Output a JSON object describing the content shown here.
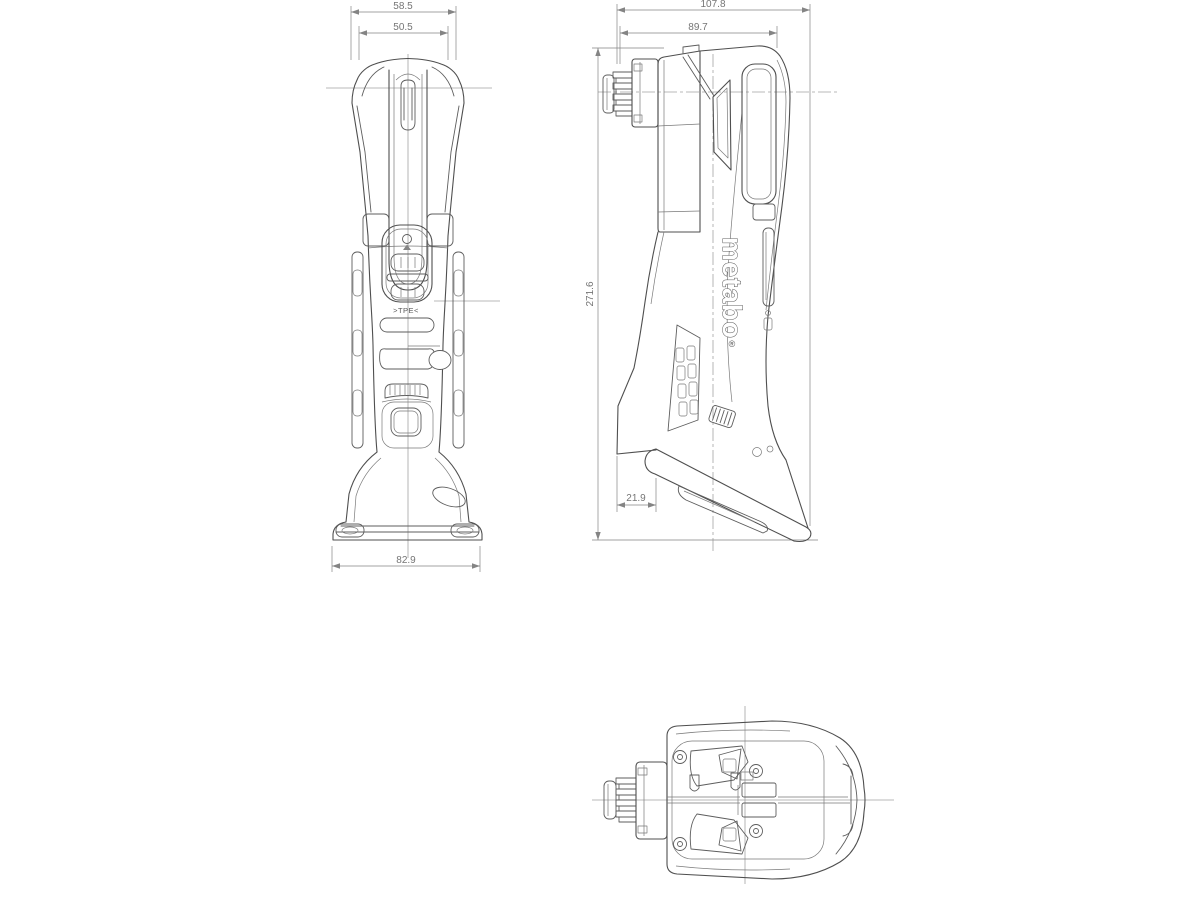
{
  "colors": {
    "background": "#ffffff",
    "line": "#4f4f4f",
    "centerline": "#a3a3a3",
    "dimension": "#848484"
  },
  "views": {
    "front": {
      "dimensions": {
        "head_width_outer": "58.5",
        "head_width_inner": "50.5",
        "base_width": "82.9"
      },
      "marking": ">TPE<"
    },
    "side": {
      "dimensions": {
        "depth_overall": "107.8",
        "depth_body": "89.7",
        "height_overall": "271.6",
        "foot_offset": "21.9"
      },
      "brand": "metabo",
      "brand_mark": "®"
    }
  }
}
